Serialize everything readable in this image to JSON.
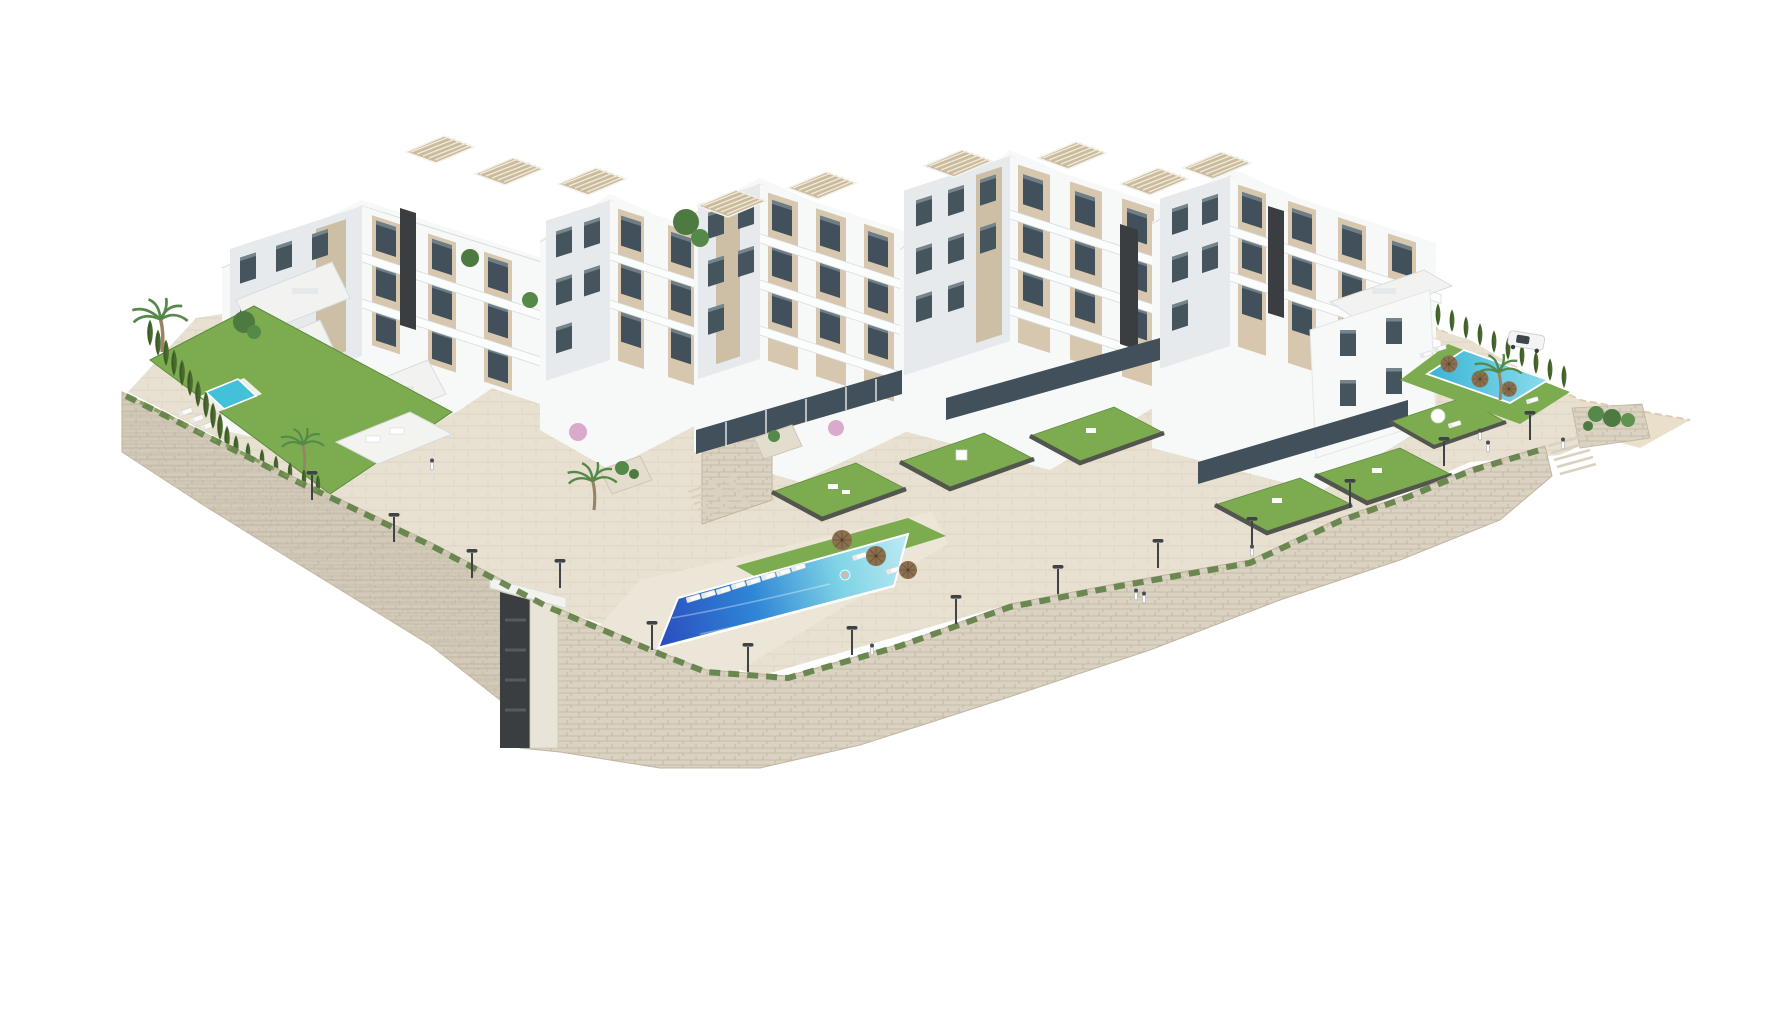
{
  "image": {
    "type": "3d-architectural-render",
    "subject": "Aerial axonometric CGI rendering of a modern white residential apartment complex built on a terraced hillside",
    "alt": "Aerial 3D render of a white multi-block apartment development with rooftop pergolas, beige facade accents, dark accent slabs, a large blue infinity pool, a small private pool on the left, a turquoise pool on the right, green lawns, cypress hedges, palm trees, limestone retaining walls, street lamps, a white car and small pedestrian figures on a white background",
    "background": "white studio backdrop, no text or watermark visible"
  },
  "scene": {
    "building_clusters": 5,
    "floors_range": "2 to 5",
    "rooftop_pergolas": 9,
    "dark_accent_slabs": 4,
    "pools": [
      {
        "id": "central-infinity-pool",
        "shape": "long trapezoid",
        "water": "gradient deep blue to pale turquoise",
        "features": [
          "infinity edge",
          "8 sun loungers",
          "3 wicker parasols",
          "swimmer"
        ]
      },
      {
        "id": "left-private-pool",
        "shape": "small rectangle",
        "water": "turquoise",
        "features": [
          "3 sun loungers",
          "lawn garden"
        ]
      },
      {
        "id": "right-pool",
        "shape": "rectangle",
        "water": "turquoise",
        "features": [
          "3 wicker parasols",
          "sun loungers",
          "palm tree",
          "cypress hedge"
        ]
      }
    ],
    "landscape": {
      "lawn_gardens": 6,
      "private_garden_squares": 6,
      "cypress_hedges": 2,
      "cypress_count": 33,
      "palm_trees": 4,
      "pink_blossom_trees": 2,
      "retaining_walls": "curved coursed-limestone walls with trailing greenery along the top edge",
      "promenade": "paved walkway along the walls with street lamps"
    },
    "objects": {
      "street_lamps": 14,
      "sun_loungers": 17,
      "wicker_parasols": 6,
      "white_parasol": 1,
      "cars": 1,
      "pedestrians": 8,
      "staircases": 3,
      "stairwell_tower": 1,
      "gazebo": 1
    }
  },
  "palette": {
    "background": "#ffffff",
    "facade_white": "#f7f8f8",
    "facade_shade": "#e7eaec",
    "roof_white": "#f2f3f1",
    "edge_gray": "#d8dcdd",
    "accent_beige": "#d6c7ae",
    "beige_shade": "#c3b196",
    "dark_slab": "#3a3e41",
    "glass": "#41505a",
    "glass_light": "#6d7e86",
    "pergola_wood": "#cbbb9e",
    "lawn": "#7cab50",
    "lawn_dark": "#5f8c3e",
    "hedge": "#49692f",
    "palm_green": "#55894a",
    "trunk": "#9a8264",
    "pool_deep": "#2a50c0",
    "pool_mid": "#2f86d6",
    "pool_light": "#7fd3e6",
    "pool_pale": "#b9e9f2",
    "pool_small": "#43c0da",
    "stone_light": "#dad3c4",
    "stone_shade": "#ccc4b1",
    "stone_line": "#c0b5a0",
    "pavement": "#e8e1d1",
    "pavement_line": "#dcd4c2",
    "terrain": "#eadfca",
    "parapet": "#53564f",
    "umbrella": "#8b7050",
    "car_body": "#f3f4f5",
    "figure_dark": "#4a4e52"
  }
}
